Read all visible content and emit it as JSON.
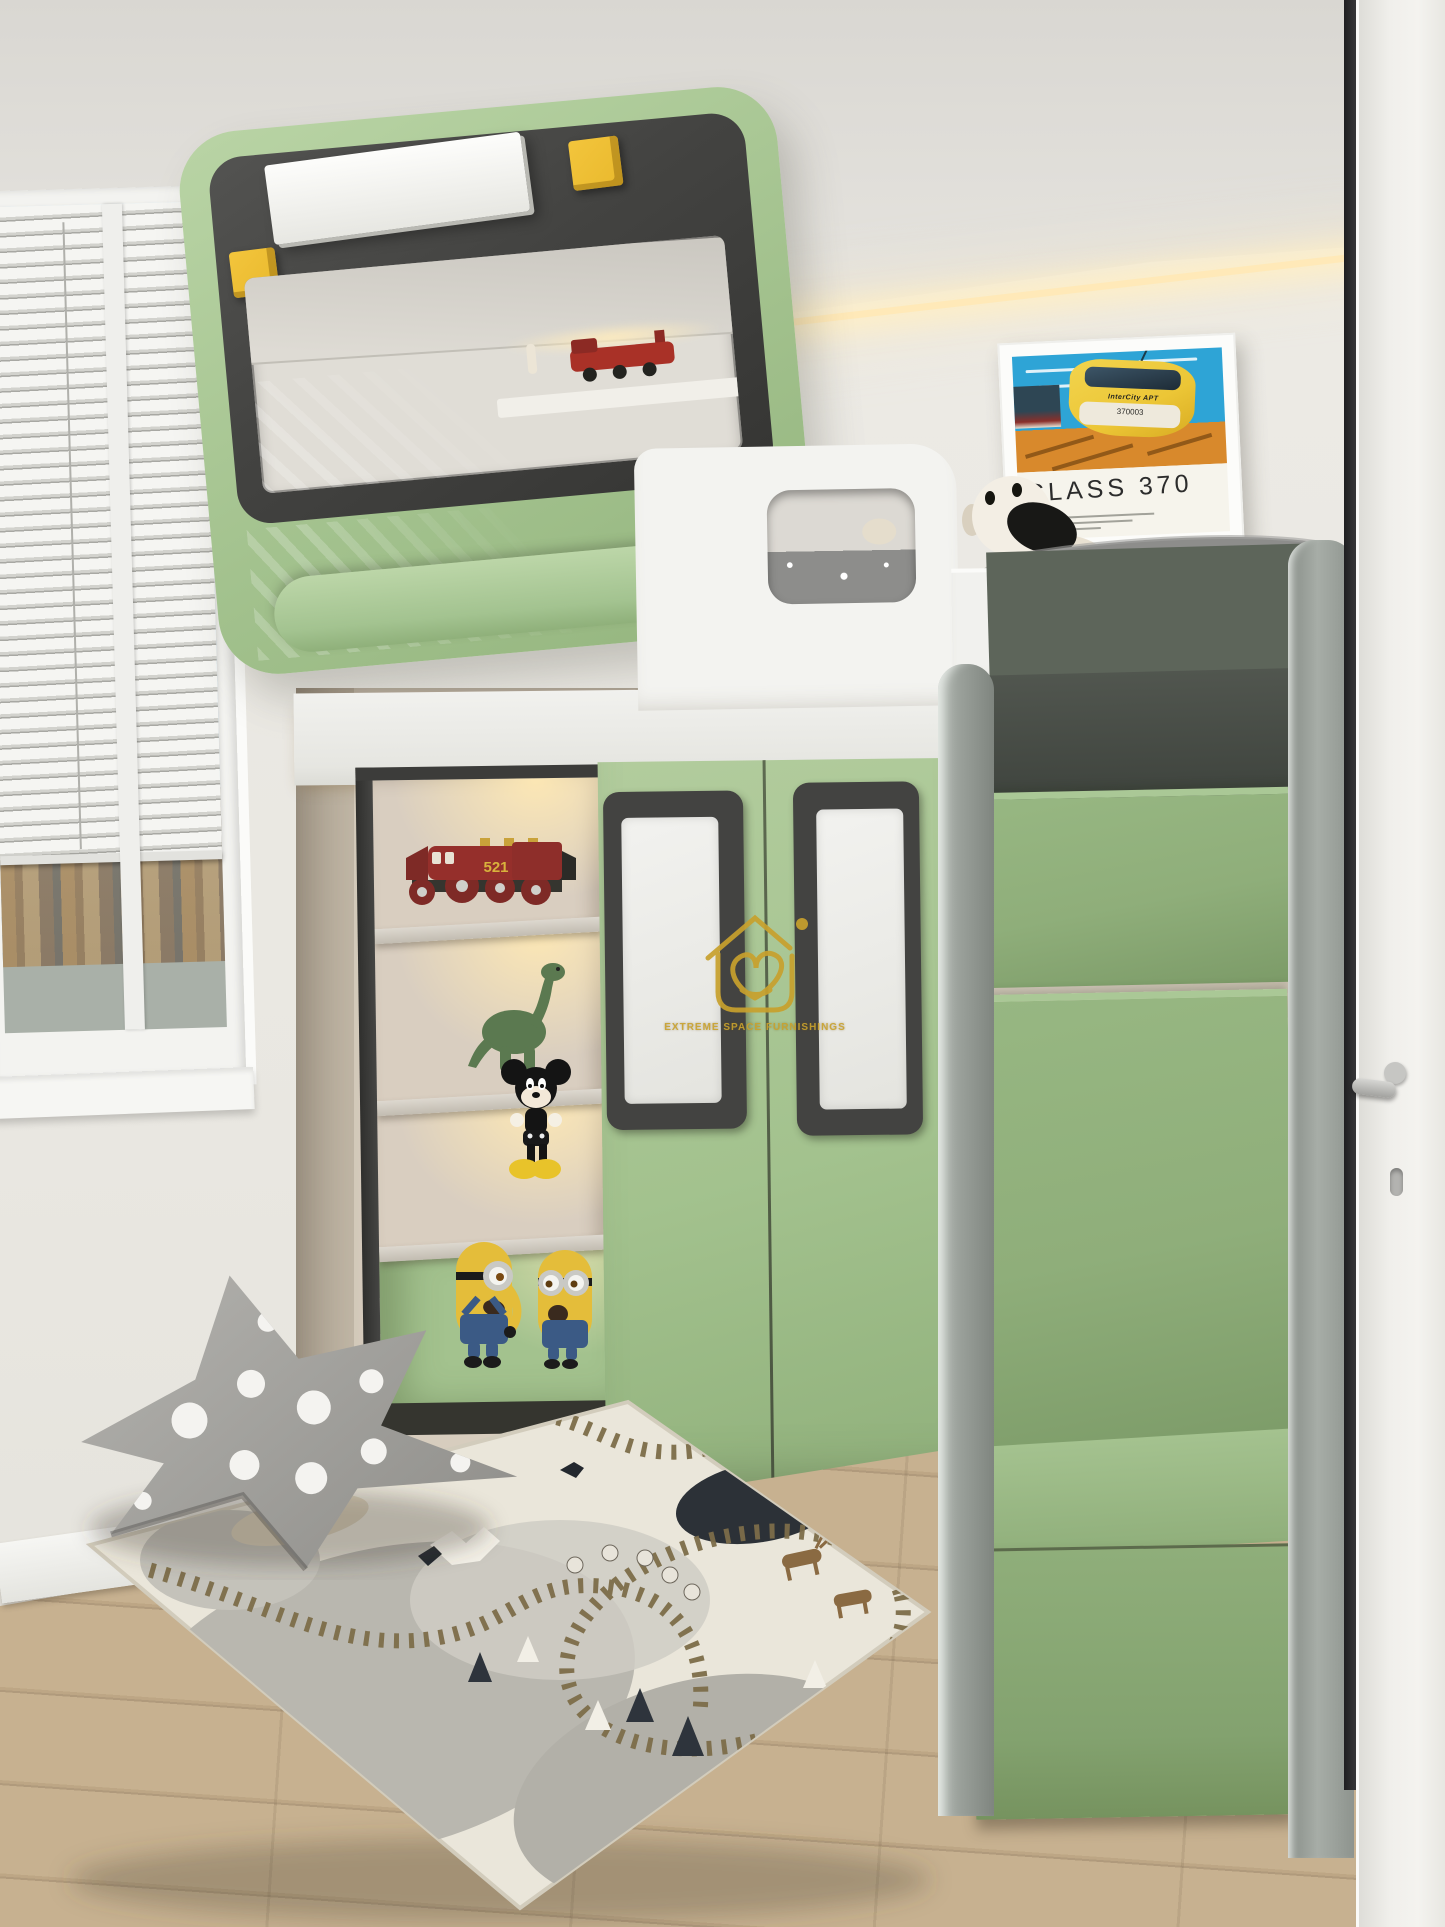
{
  "scene": {
    "title": "Children's bedroom render with train-themed loft bed",
    "style": "3D interior visualization"
  },
  "poster": {
    "title": "CLASS 370",
    "train_number": "370003",
    "brand": "InterCity",
    "brand_suffix": "APT"
  },
  "toys": {
    "locomotive_number": "521"
  },
  "logo": {
    "text": "EXTREME SPACE FURNISHINGS"
  },
  "colors": {
    "wall": "#edebe6",
    "ceiling": "#e3e1dc",
    "cove": "#ffe9b8",
    "green_light": "#b9d4a5",
    "green": "#a3c28e",
    "green_stairs": "#8fae7a",
    "charcoal": "#434341",
    "yellow": "#e9b92d",
    "gold": "#c8a12d",
    "white_furniture": "#f3f3f0",
    "alcove": "#d7cdbe",
    "bedding": "#8d8d8b",
    "wood": "#c7b190",
    "wood_line": "#b09a7c",
    "sky": "#aedaf0",
    "poster_sky": "#2ea4d6",
    "poster_ground": "#d8892c",
    "poster_yellow": "#ecc636",
    "red_toy": "#9e3430",
    "rug_cream": "#eae6da",
    "rug_gray": "#b8b6ae",
    "rug_pond": "#2c3137",
    "track": "#7d6d49"
  }
}
